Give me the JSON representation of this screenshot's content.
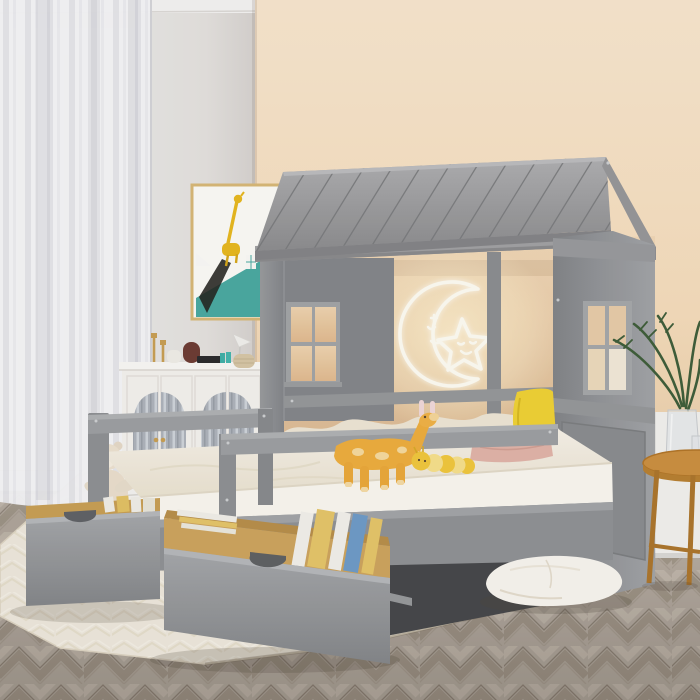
{
  "scene": {
    "type": "product-photo",
    "description": "Kids bedroom with a gray wooden house-frame twin bed with roof, window cutouts and two pulled-out storage drawers full of books; a second lower bed with guard rails in front; neon moon-and-star light on the peach wall; white sideboard with arched fluted-mirror doors, giraffe wall art, sheer white curtain, herringbone wood floor, cream rug, plush toys, floor pillow and a wooden side table with a plant",
    "objects": [
      "sheer-curtain",
      "left-wall",
      "peach-wall",
      "giraffe-wall-art",
      "white-sideboard",
      "house-bed-roof",
      "house-gable",
      "left-window",
      "right-window",
      "neon-moon-star-light",
      "back-bed-bedding",
      "yellow-pillow",
      "pink-pillow",
      "front-bed",
      "guard-rails",
      "storage-drawer-left",
      "storage-drawer-right",
      "books-in-drawer",
      "teddy-bear",
      "storage-crates",
      "plush-giraffe",
      "plush-caterpillar",
      "floor-pouf",
      "area-rug",
      "herringbone-floor",
      "side-table",
      "glass-vase",
      "palm-plant",
      "white-wall-panel"
    ]
  },
  "palette": {
    "wall_peach": "#f8e4c9",
    "wall_left": "#eceae8",
    "frame_gray": "#97999b",
    "frame_light": "#a8aaac",
    "frame_dark": "#85878a",
    "roof_gray": "#9c9c9e",
    "mattress_white": "#f7f2e8",
    "bedding_cream": "#efe7d6",
    "pillow_yellow": "#f1d335",
    "pillow_pink": "#e2b5a9",
    "floor_taupe": "#b5aba0",
    "rug_cream": "#efe9dd",
    "cabinet_white": "#f5f3ef",
    "art_teal": "#4aaaa2",
    "art_yellow": "#e9b91f",
    "wood_drawer": "#cfa55e",
    "table_wood": "#cd9040",
    "plant_green": "#47663f",
    "neon_white": "#fffdf4",
    "plush_giraffe": "#efae3e",
    "bear_cream": "#ecdfce",
    "book_blue": "#6f9cc8",
    "book_manila": "#e6c66a",
    "under_bed_dark": "#46474a"
  }
}
